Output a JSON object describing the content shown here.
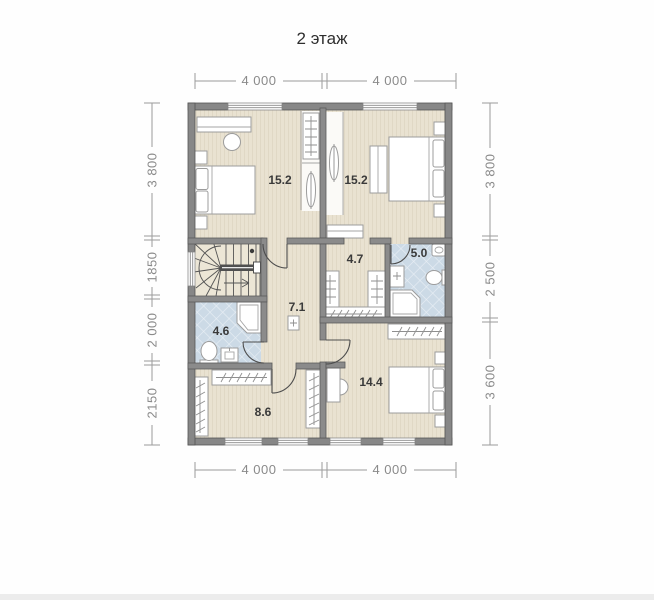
{
  "title": "2 этаж",
  "dimensions": {
    "top": [
      "4 000",
      "4 000"
    ],
    "bottom": [
      "4 000",
      "4 000"
    ],
    "left": [
      "3 800",
      "1850",
      "2 000",
      "2150"
    ],
    "right": [
      "3 800",
      "2 500",
      "3 600"
    ]
  },
  "rooms": {
    "bedroom1": "15.2",
    "bedroom2": "15.2",
    "wardrobe": "4.7",
    "wc_small": "5.0",
    "hall": "7.1",
    "bathroom": "4.6",
    "dressing": "8.6",
    "bedroom3": "14.4"
  },
  "colors": {
    "wall": "#878787",
    "floor": "#e9e2d1",
    "tile": "#ccdae6",
    "dimension_text": "#8a8a8a",
    "room_label": "#3a3a3a"
  }
}
